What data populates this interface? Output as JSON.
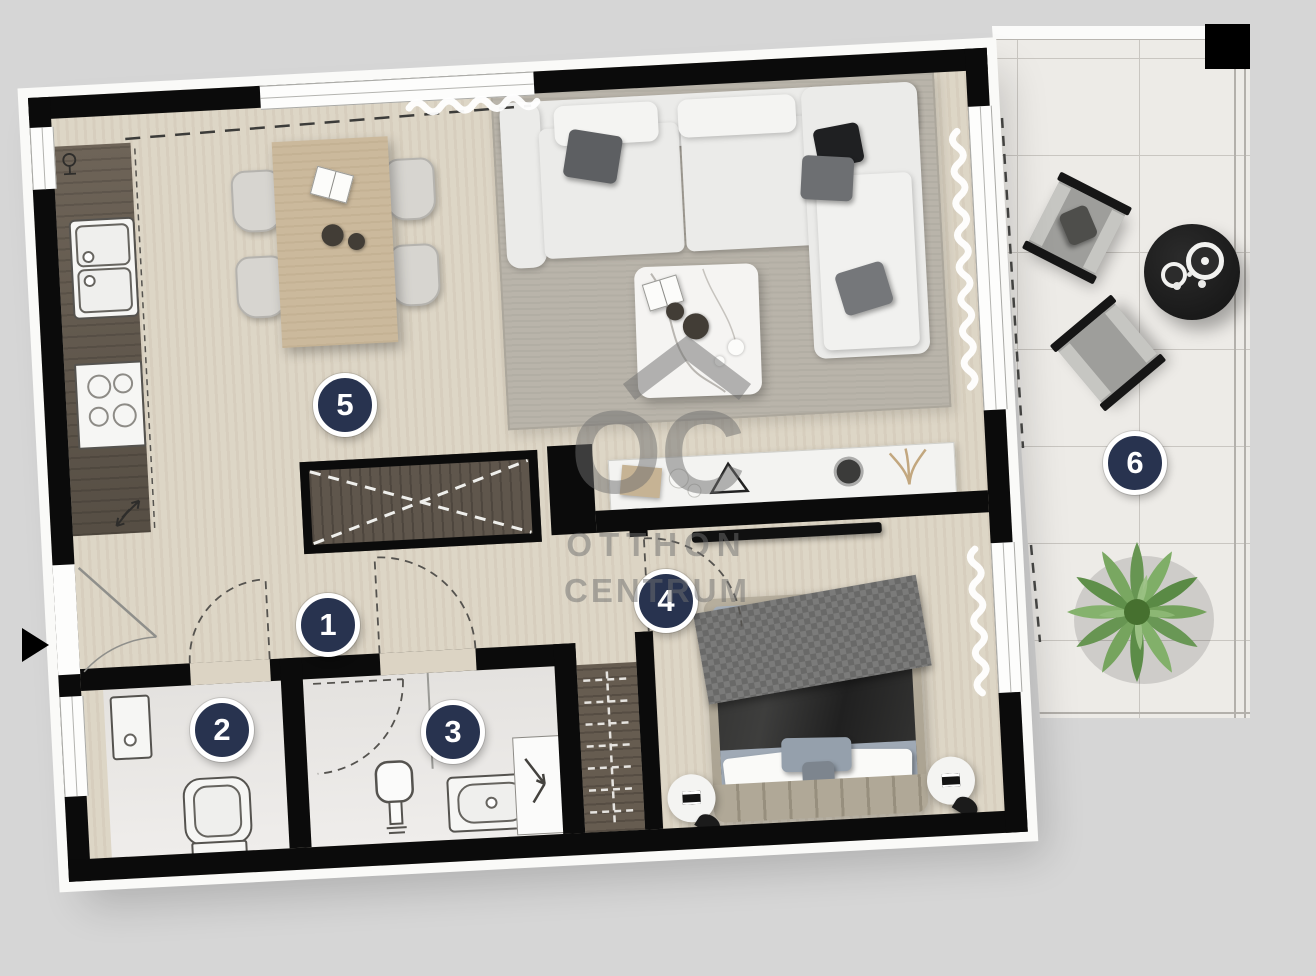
{
  "floorplan": {
    "badges": [
      {
        "number": "1"
      },
      {
        "number": "2"
      },
      {
        "number": "3"
      },
      {
        "number": "4"
      },
      {
        "number": "5"
      },
      {
        "number": "6"
      }
    ],
    "watermark": {
      "logo": "OC",
      "line1": "OTTHON",
      "line2": "CENTRUM"
    },
    "colors": {
      "background": "#d6d6d6",
      "wall": "#0b0b0b",
      "badge_fill": "#28334f",
      "badge_text": "#ffffff",
      "wood_floor": "#dcd4c4",
      "dark_wood": "#675d52",
      "table_wood": "#cbb99c",
      "rug": "#b9b4aa",
      "bath_tile": "#e8e6e3",
      "terrace_tile": "#edebe7",
      "terrace_line": "#c9c6c1",
      "sofa": "#ebebe9",
      "bed_frame": "#b2aa99",
      "bed_sheet": "#9fa9b5",
      "blanket": "#2e2e2f",
      "plant": "#71a157",
      "watermark": "#6f6f6f"
    }
  }
}
